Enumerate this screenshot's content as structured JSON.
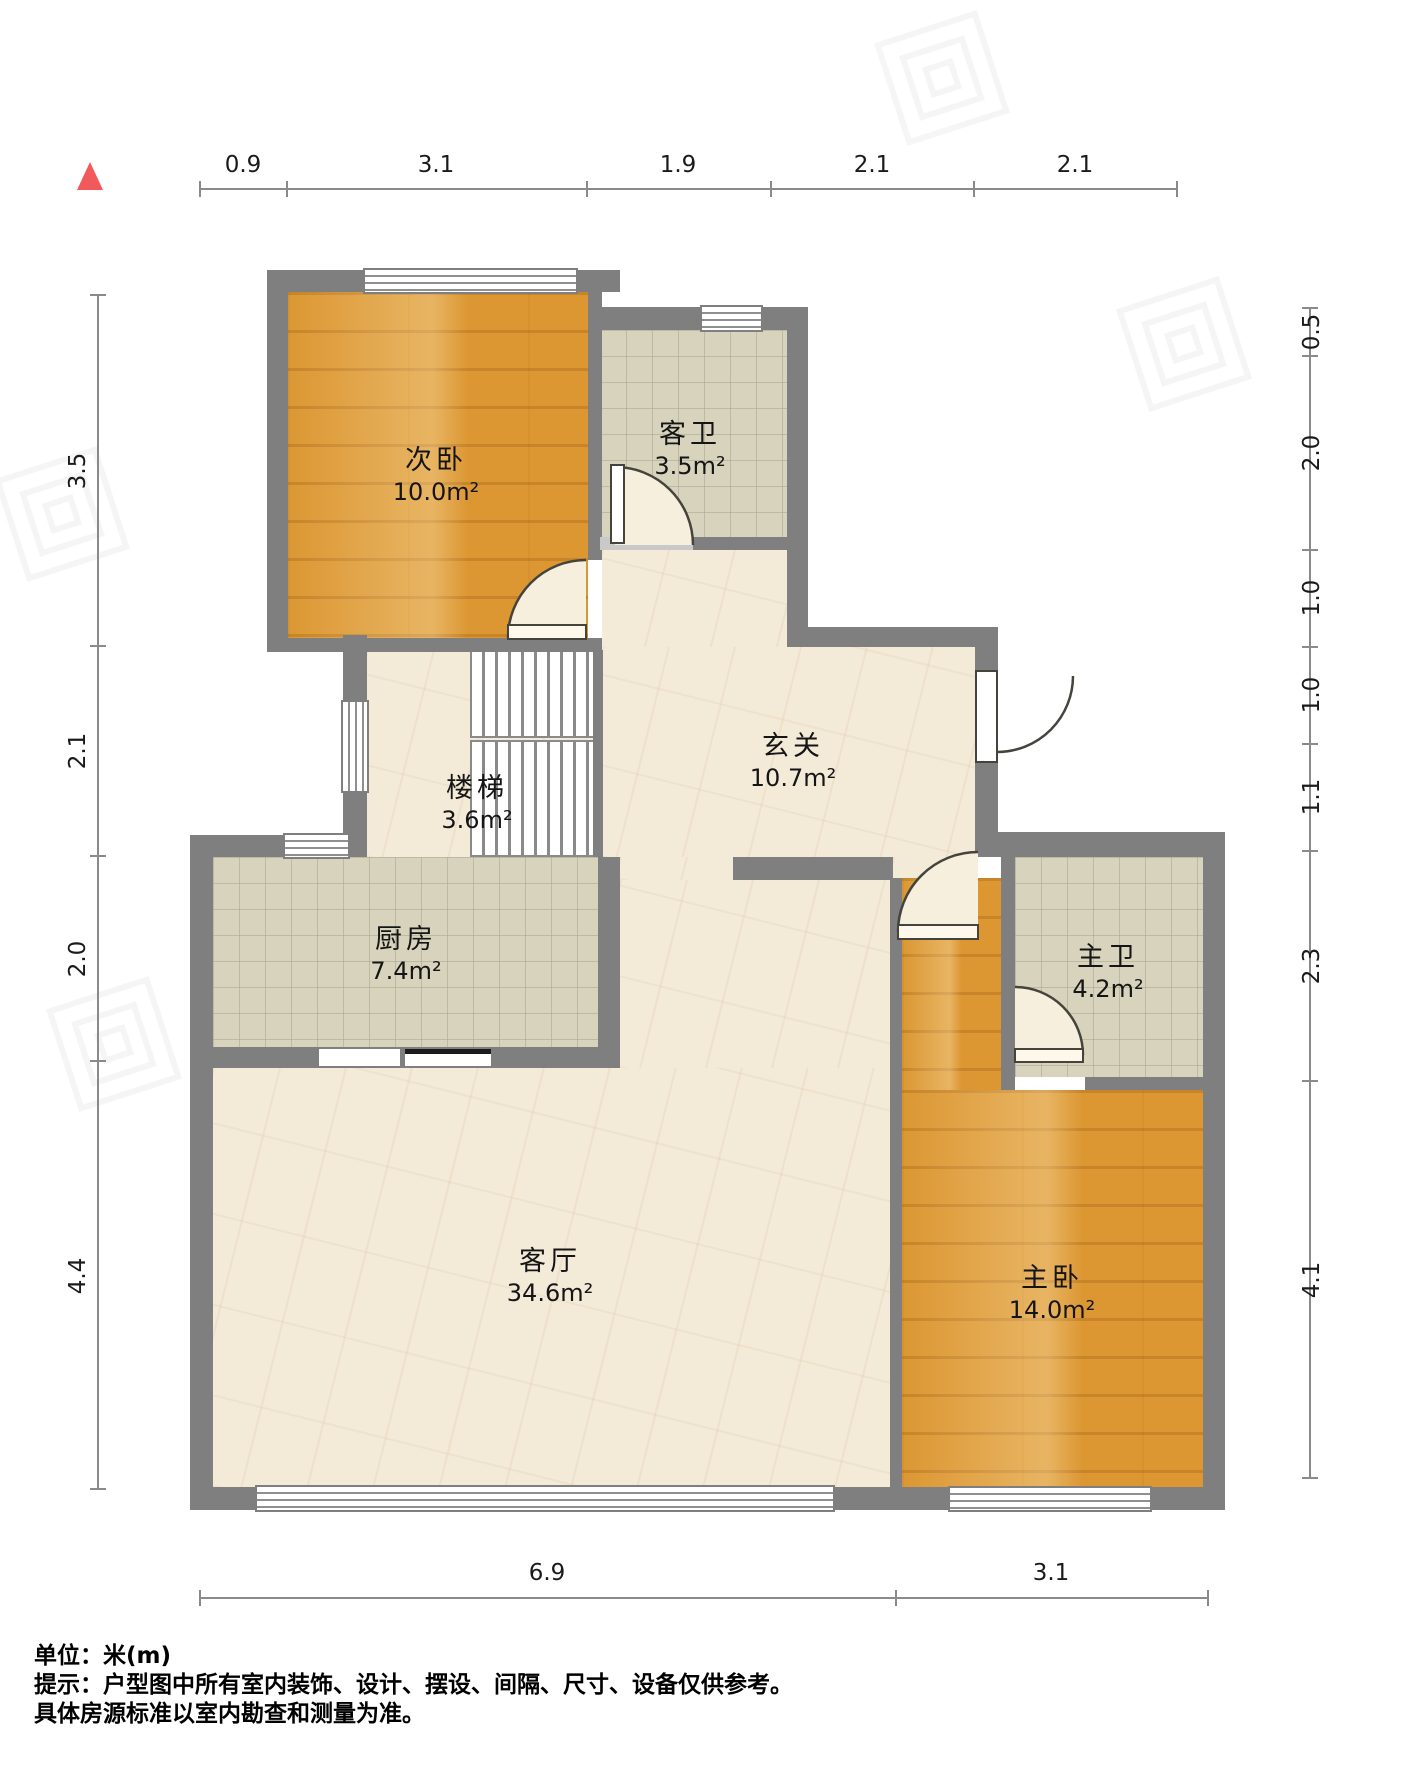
{
  "plan": {
    "rooms": [
      {
        "name": "次卧",
        "area": "10.0m²"
      },
      {
        "name": "客卫",
        "area": "3.5m²"
      },
      {
        "name": "玄关",
        "area": "10.7m²"
      },
      {
        "name": "楼梯",
        "area": "3.6m²"
      },
      {
        "name": "厨房",
        "area": "7.4m²"
      },
      {
        "name": "主卫",
        "area": "4.2m²"
      },
      {
        "name": "客厅",
        "area": "34.6m²"
      },
      {
        "name": "主卧",
        "area": "14.0m²"
      }
    ],
    "dimensions": {
      "top": [
        "0.9",
        "3.1",
        "1.9",
        "2.1",
        "2.1"
      ],
      "left": [
        "3.5",
        "2.1",
        "2.0",
        "4.4"
      ],
      "right": [
        "0.5",
        "2.0",
        "1.0",
        "1.0",
        "1.1",
        "2.3",
        "4.1"
      ],
      "bottom": [
        "6.9",
        "3.1"
      ]
    },
    "colors": {
      "wall": "#7f7f7f",
      "wood_floor": "#dc9733",
      "tile_floor": "#d8d3bc",
      "marble_floor": "#f3ead8",
      "north_marker": "#f1595a"
    }
  },
  "footer": {
    "line1": "单位：米(m)",
    "line2": "提示：户型图中所有室内装饰、设计、摆设、间隔、尺寸、设备仅供参考。",
    "line3": "具体房源标准以室内勘查和测量为准。"
  }
}
